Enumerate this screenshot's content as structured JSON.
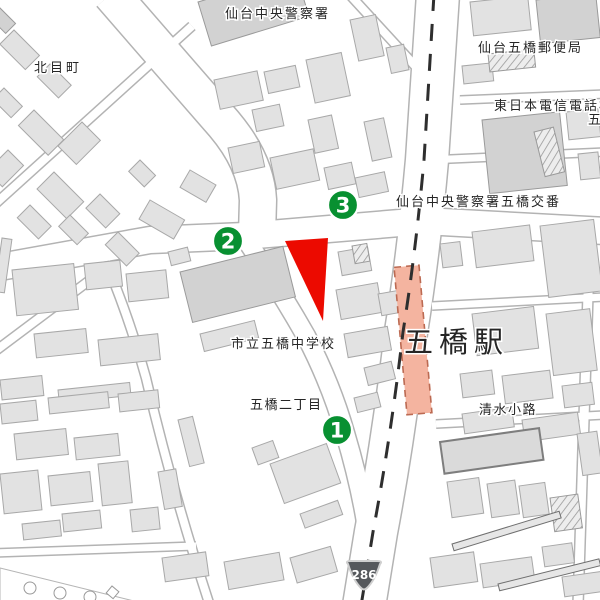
{
  "map": {
    "colors": {
      "background": "#ffffff",
      "building_fill": "#e2e2e2",
      "road_fill": "#ffffff",
      "road_casing": "#b3b3b3",
      "parcel_red": "#ec0a00",
      "marker_green": "#089031",
      "marker_ring": "#ffffff",
      "station_fill": "#f4b4a0",
      "station_stroke": "#bc6a52",
      "railway": "#2e2e2e",
      "shield_fill": "#55585c",
      "shield_ring": "#cfcfcf",
      "label_text": "#262626"
    },
    "labels": [
      {
        "id": "kitamemachi",
        "text": "北目町",
        "x": 34,
        "y": 72,
        "size": 13,
        "spacing": 3
      },
      {
        "id": "sendai-central-police",
        "text": "仙台中央警察署",
        "x": 225,
        "y": 18,
        "size": 13,
        "spacing": 2
      },
      {
        "id": "itsutsubashi-post-office",
        "text": "仙台五橋郵便局",
        "x": 478,
        "y": 52,
        "size": 13,
        "spacing": 2
      },
      {
        "id": "ntt-east-line1",
        "text": "東日本電信電話株",
        "x": 494,
        "y": 110,
        "size": 13,
        "spacing": 2
      },
      {
        "id": "ntt-east-line2",
        "text": "五",
        "x": 588,
        "y": 124,
        "size": 13,
        "spacing": 2
      },
      {
        "id": "itsutsubashi-koban",
        "text": "仙台中央警察署五橋交番",
        "x": 396,
        "y": 206,
        "size": 13,
        "spacing": 2
      },
      {
        "id": "itsutsubashi-junior-high",
        "text": "市立五橋中学校",
        "x": 231,
        "y": 348,
        "size": 13,
        "spacing": 2
      },
      {
        "id": "itsutsubashi-2chome",
        "text": "五橋二丁目",
        "x": 250,
        "y": 409,
        "size": 13,
        "spacing": 1.5
      },
      {
        "id": "itsutsubashi-station",
        "text": "五橋駅",
        "x": 404,
        "y": 352,
        "size": 29,
        "spacing": 6
      },
      {
        "id": "shimizukoji",
        "text": "清水小路",
        "x": 479,
        "y": 414,
        "size": 13,
        "spacing": 1.5
      }
    ],
    "markers": [
      {
        "n": "1",
        "x": 337,
        "y": 430
      },
      {
        "n": "2",
        "x": 228,
        "y": 241
      },
      {
        "n": "3",
        "x": 343,
        "y": 205
      }
    ],
    "route_shield": {
      "number": "286",
      "x": 364,
      "y": 576
    }
  }
}
